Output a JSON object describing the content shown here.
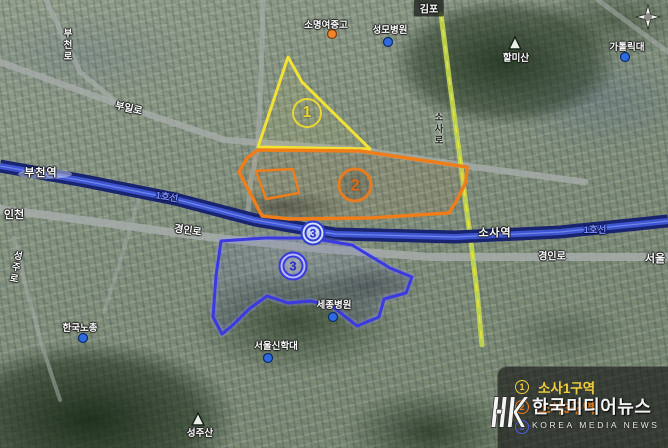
{
  "map": {
    "stations": [
      {
        "name": "부천역"
      },
      {
        "name": "소사역"
      }
    ],
    "line_badges": [
      "1호선",
      "1호선"
    ],
    "road_labels": [
      {
        "text": "부일로"
      },
      {
        "text": "부천로"
      },
      {
        "text": "소사로"
      },
      {
        "text": "경인로"
      },
      {
        "text": "경인로"
      },
      {
        "text": "성주로"
      }
    ],
    "direction_labels": [
      {
        "text": "김포"
      },
      {
        "text": "인천"
      },
      {
        "text": "서울"
      }
    ],
    "pois": [
      {
        "text": "소명여중고",
        "dot": "orange"
      },
      {
        "text": "성모병원",
        "dot": "blue"
      },
      {
        "text": "가톨릭대",
        "dot": "blue"
      },
      {
        "text": "세종병원",
        "dot": "blue"
      },
      {
        "text": "서울신학대",
        "dot": "blue"
      },
      {
        "text": "한국노총",
        "dot": "blue"
      }
    ],
    "mountains": [
      {
        "text": "할미산"
      },
      {
        "text": "성주산"
      }
    ],
    "zone_markers": [
      {
        "num": "1"
      },
      {
        "num": "2"
      },
      {
        "num": "3"
      },
      {
        "num": "3"
      }
    ]
  },
  "legend": {
    "items": [
      {
        "num": "1",
        "label": "소사1구역",
        "color": "#f2cf3a"
      },
      {
        "num": "2",
        "label": "소사3구역",
        "color": "#ed7d1d"
      },
      {
        "num": "3",
        "label": "",
        "color": "#4a5ae8"
      }
    ]
  },
  "watermark": {
    "logo": "HK",
    "title": "한국미디어뉴스",
    "subtitle": "KOREA MEDIA NEWS"
  },
  "colors": {
    "zone1_outline": "#f2e235",
    "zone2_outline": "#ee7d1a",
    "zone3_outline": "#3a3ae0",
    "railway": "#18246f",
    "railway_center": "#3d55cf",
    "highlight_road": "#c3d94f"
  }
}
